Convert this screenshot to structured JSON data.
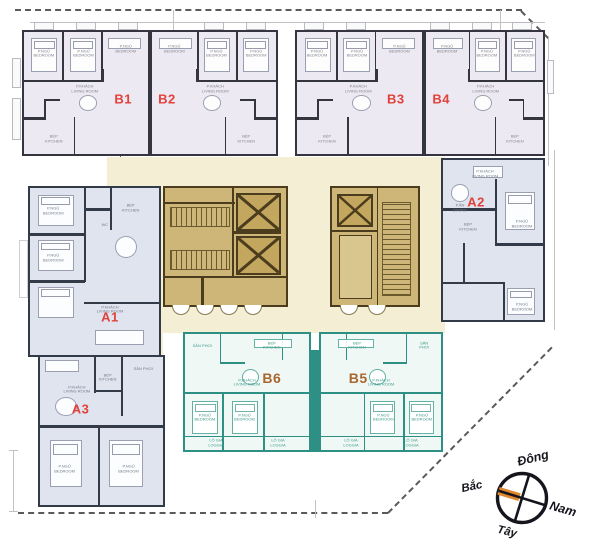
{
  "room_labels": {
    "living": "P.KHÁCH\nLIVING ROOM",
    "bedroom": "P.NGỦ\nBEDROOM",
    "kitchen": "BẾP\nKITCHEN",
    "dining": "P.ĂN\nDINING",
    "loggia": "LÔ GIA\nLOGGIA",
    "yard": "SÂN PHƠI",
    "wc": "WC"
  },
  "units": [
    {
      "id": "B1",
      "label": "B1",
      "type": "b_top",
      "scheme": "pink",
      "label_color": "red",
      "x": 22,
      "y": 30,
      "w": 128,
      "h": 126,
      "mirror": false,
      "label_pos": [
        80,
        55
      ]
    },
    {
      "id": "B2",
      "label": "B2",
      "type": "b_top",
      "scheme": "pink",
      "label_color": "red",
      "x": 150,
      "y": 30,
      "w": 128,
      "h": 126,
      "mirror": true,
      "label_pos": [
        12,
        55
      ]
    },
    {
      "id": "B3",
      "label": "B3",
      "type": "b_top",
      "scheme": "pink",
      "label_color": "red",
      "x": 295,
      "y": 30,
      "w": 129,
      "h": 126,
      "mirror": false,
      "label_pos": [
        79,
        55
      ]
    },
    {
      "id": "B4",
      "label": "B4",
      "type": "b_top",
      "scheme": "pink",
      "label_color": "red",
      "x": 424,
      "y": 30,
      "w": 121,
      "h": 126,
      "mirror": true,
      "label_pos": [
        13,
        55
      ]
    },
    {
      "id": "A1",
      "label": "A1",
      "type": "a1",
      "scheme": "blue",
      "label_color": "red",
      "x": 28,
      "y": 186,
      "w": 133,
      "h": 171,
      "mirror": false,
      "label_pos": [
        62,
        77
      ]
    },
    {
      "id": "A2",
      "label": "A2",
      "type": "a2",
      "scheme": "blue",
      "label_color": "red",
      "x": 441,
      "y": 158,
      "w": 104,
      "h": 164,
      "mirror": false,
      "label_pos": [
        33,
        26
      ]
    },
    {
      "id": "A3",
      "label": "A3",
      "type": "a3",
      "scheme": "blue",
      "label_color": "red",
      "x": 38,
      "y": 355,
      "w": 127,
      "h": 152,
      "mirror": false,
      "label_pos": [
        33,
        35
      ]
    },
    {
      "id": "B6",
      "label": "B6",
      "type": "b_bot",
      "scheme": "teal",
      "label_color": "brown",
      "x": 183,
      "y": 332,
      "w": 128,
      "h": 120,
      "mirror": false,
      "label_pos": [
        70,
        38
      ]
    },
    {
      "id": "B5",
      "label": "B5",
      "type": "b_bot",
      "scheme": "teal",
      "label_color": "brown",
      "x": 319,
      "y": 332,
      "w": 124,
      "h": 120,
      "mirror": true,
      "label_pos": [
        31,
        38
      ]
    }
  ],
  "compass": {
    "east": "Đông",
    "west": "Tây",
    "north": "Bắc",
    "south": "Nam"
  },
  "colors": {
    "unit_b_top_fill": "#ece9f2",
    "unit_a_fill": "#dfe4ee",
    "unit_b_bot_fill": "#eff8f4",
    "b_top_wall": "#35353f",
    "a_wall": "#333b48",
    "teal_wall": "#2e8f85",
    "core_fill": "#cdb678",
    "core_wall": "#4a3c1c",
    "corridor_fill": "#f3eed4",
    "label_red": "#e2413b",
    "label_brown": "#a8672f",
    "compass_orange": "#e0862c"
  }
}
